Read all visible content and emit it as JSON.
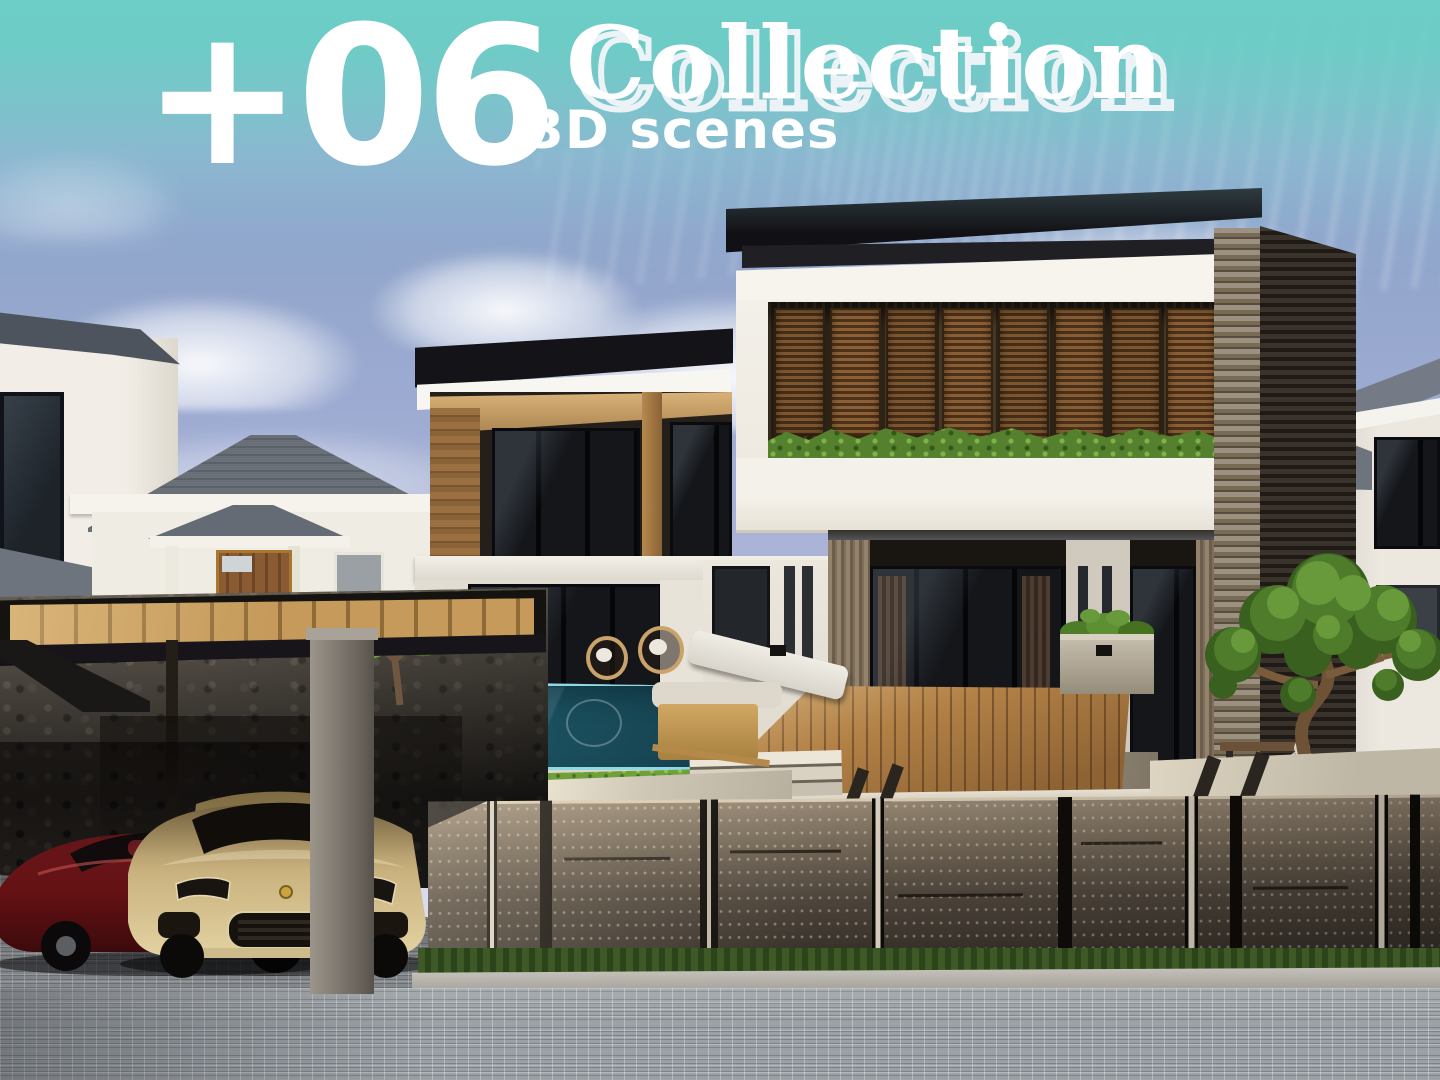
{
  "overlay": {
    "count": "+06",
    "title": "Collection",
    "subtitle": "3D scenes",
    "banner_color": "#6CCEC6",
    "text_color": "#FFFFFF"
  },
  "palette": {
    "sky_top": "#7FB7C9",
    "sky_mid": "#9DABD2",
    "sky_low": "#DCDEEE",
    "cloud": "#E9ECF5",
    "roof_fascia_dark": "#141318",
    "wall_white": "#F4F1EA",
    "balcony_wood": "#9A7040",
    "louver_shutter_wood": "#6B4626",
    "hedge_green": "#5D8A33",
    "grass_green": "#6FA03C",
    "pool_water_deep": "#1D5B6D",
    "pool_rim_light": "#8FD8E4",
    "deck_wood": "#AD7D43",
    "stone_wall": "#3E3931",
    "concrete_fence": "#6F6353",
    "concrete_pillar": "#7D7872",
    "street_cobble": "#9AA0A5",
    "car_red": "#8E171B",
    "car_gold": "#C9B27E",
    "slat_wall_dark": "#2B251E",
    "brick_pilaster": "#8C8070"
  },
  "scene": {
    "kind": "3d-architectural-render",
    "elements": [
      "sky-with-clouds",
      "teal-gradient-banner",
      "neighbor-house-left",
      "neighbor-house-center",
      "neighbor-house-right",
      "villa-left-wing-balcony",
      "villa-right-wing",
      "wood-louver-shutters",
      "balcony-hedge-planter",
      "swimming-pool",
      "pool-floats",
      "wood-deck",
      "terrace-steps",
      "rattan-chairs",
      "sun-lounger",
      "wood-stool",
      "pergola-carport",
      "stone-rubble-wall",
      "frangipani-plant",
      "concrete-pillar",
      "red-sports-car",
      "gold-porsche-suv",
      "concrete-slab-fence",
      "hedge-strip",
      "curb",
      "cobblestone-street",
      "garden-bench",
      "buddha-head-statue",
      "bonsai-tree",
      "planter-box"
    ]
  }
}
